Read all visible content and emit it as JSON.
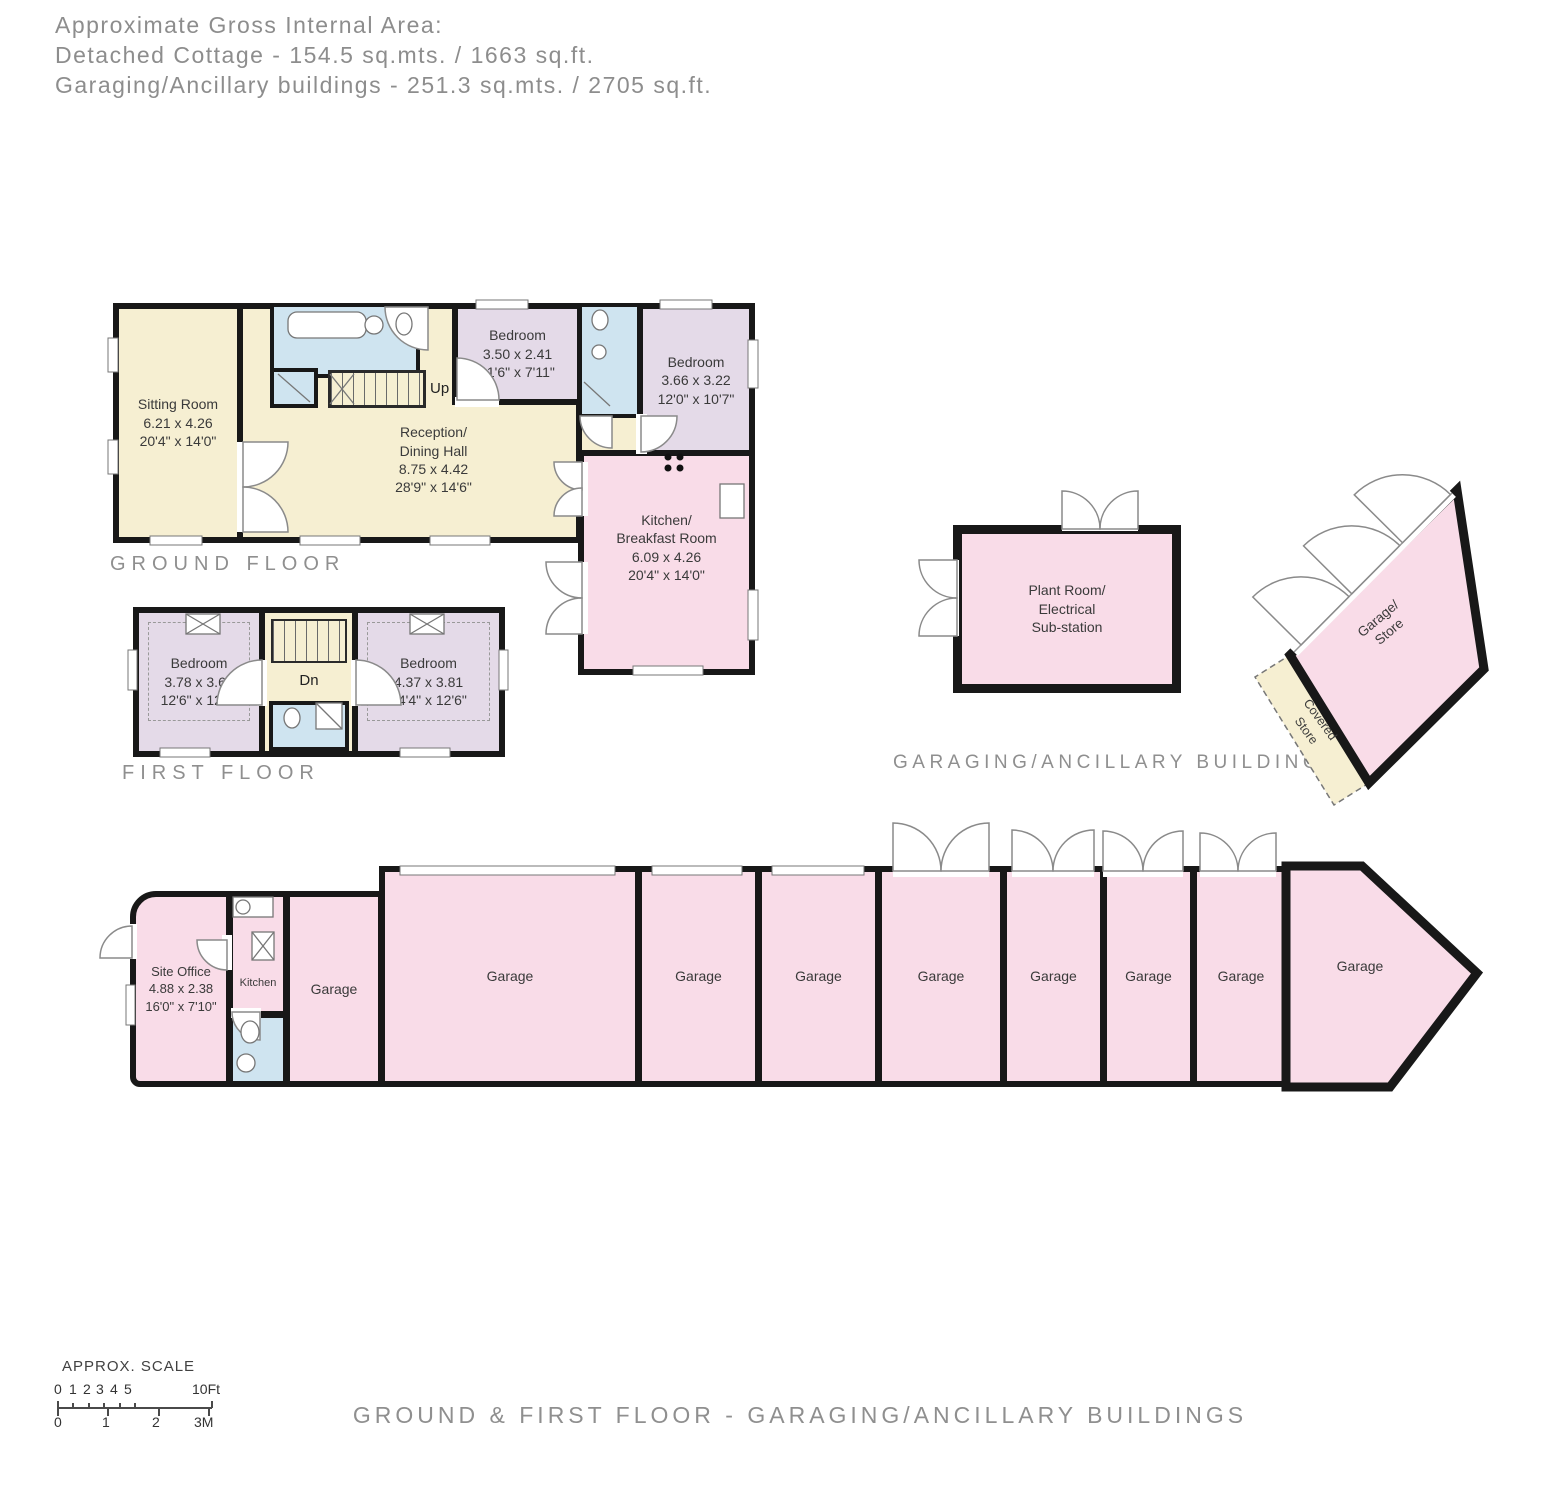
{
  "header": {
    "line1": "Approximate Gross Internal Area:",
    "line2": "Detached Cottage - 154.5 sq.mts. / 1663 sq.ft.",
    "line3": "Garaging/Ancillary buildings - 251.3 sq.mts. / 2705 sq.ft."
  },
  "ground_floor": {
    "label": "GROUND FLOOR",
    "rooms": {
      "sitting_room": {
        "lines": [
          "Sitting Room",
          "6.21 x 4.26",
          "20'4\" x 14'0\""
        ]
      },
      "reception": {
        "lines": [
          "Reception/",
          "Dining Hall",
          "8.75 x 4.42",
          "28'9\" x 14'6\""
        ]
      },
      "bedroom1": {
        "lines": [
          "Bedroom",
          "3.50 x 2.41",
          "11'6\" x 7'11\""
        ]
      },
      "bedroom2": {
        "lines": [
          "Bedroom",
          "3.66 x 3.22",
          "12'0\" x 10'7\""
        ]
      },
      "kitchen": {
        "lines": [
          "Kitchen/",
          "Breakfast Room",
          "6.09 x 4.26",
          "20'4\" x 14'0\""
        ]
      },
      "stairs_up": "Up"
    }
  },
  "first_floor": {
    "label": "FIRST FLOOR",
    "rooms": {
      "bedroom3": {
        "lines": [
          "Bedroom",
          "3.78 x 3.66",
          "12'6\" x 12'0\""
        ]
      },
      "bedroom4": {
        "lines": [
          "Bedroom",
          "4.37 x 3.81",
          "14'4\" x 12'6\""
        ]
      },
      "stairs_dn": "Dn"
    }
  },
  "ancillary": {
    "label": "GARAGING/ANCILLARY BUILDINGS",
    "plant_room": {
      "lines": [
        "Plant Room/",
        "Electrical",
        "Sub-station"
      ]
    },
    "garage_store": {
      "lines": [
        "Garage/",
        "Store"
      ]
    },
    "covered_store": {
      "lines": [
        "Covered",
        "Store"
      ]
    }
  },
  "garage_row": {
    "site_office": {
      "lines": [
        "Site Office",
        "4.88 x 2.38",
        "16'0\" x 7'10\""
      ]
    },
    "kitchen_label": "Kitchen",
    "garages": [
      {
        "label": "Garage"
      },
      {
        "label": "Garage"
      },
      {
        "label": "Garage"
      },
      {
        "label": "Garage"
      },
      {
        "label": "Garage"
      },
      {
        "label": "Garage"
      },
      {
        "label": "Garage"
      },
      {
        "label": "Garage"
      },
      {
        "label": "Garage"
      }
    ]
  },
  "scale": {
    "title": "APPROX. SCALE",
    "ft_ticks": [
      "0",
      "1",
      "2",
      "3",
      "4",
      "5"
    ],
    "ft_max": "10Ft",
    "m_ticks": [
      "0",
      "1",
      "2",
      "3M"
    ]
  },
  "footer": {
    "caption": "GROUND & FIRST FLOOR - GARAGING/ANCILLARY BUILDINGS"
  },
  "colors": {
    "wall": "#181818",
    "cream": "#f6efd2",
    "pink": "#f9dce8",
    "purple": "#e4dae8",
    "blue": "#cfe4f0",
    "label_gray": "#8f8f8f"
  }
}
